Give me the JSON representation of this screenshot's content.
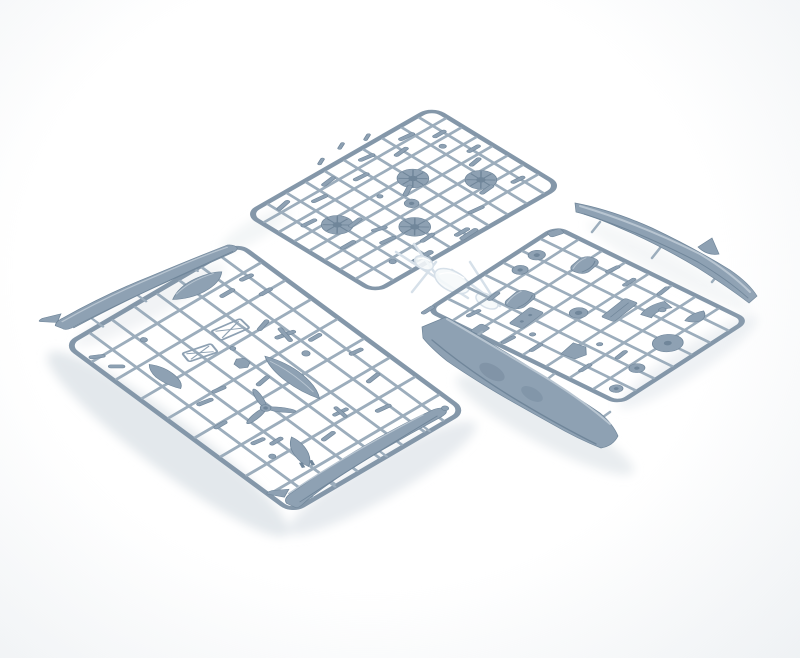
{
  "meta": {
    "type": "photograph",
    "subject": "Grey-blue injection-molded plastic model aircraft kit sprues on a white background",
    "style": "high-key studio product photo, no visible text"
  },
  "palette": {
    "background": "#ffffff",
    "vignette": "rgba(222,228,233,0.5)",
    "shadow": "#e3e8ec",
    "runner": "#9cadbc",
    "runner_dark": "#8497a9",
    "part_mid": "#8ea1b3",
    "part_dark": "#70869a",
    "part_light": "#b8c5d1",
    "clear_fill": "rgba(246,249,251,0.88)",
    "clear_edge": "#d6e0e9",
    "glint": "#ffffff"
  },
  "sprues": [
    {
      "id": "sprue-small-parts",
      "position": "top center, tilted",
      "plastic": "grey-blue styrene",
      "contents": [
        "four spoked main wheels",
        "wheel hub",
        "landing gear struts",
        "small fittings"
      ]
    },
    {
      "id": "sprue-fuselage-armament",
      "position": "lower left, tilted",
      "plastic": "grey-blue styrene",
      "contents": [
        "two fuselage halves",
        "three-blade propeller",
        "drop tanks",
        "bomb",
        "cockpit ladder frames",
        "hub",
        "small fittings"
      ]
    },
    {
      "id": "sprue-wing",
      "position": "right, tilted",
      "plastic": "grey-blue styrene",
      "contents": [
        "one-piece lower wing",
        "upper fuselage spine with fin",
        "engine cowling halves",
        "cowling front ring",
        "bulkhead discs",
        "instrument panels"
      ]
    },
    {
      "id": "sprue-clear",
      "position": "center, between the grey sprues",
      "plastic": "clear styrene",
      "contents": [
        "canopy",
        "windscreen",
        "small transparency"
      ]
    }
  ]
}
